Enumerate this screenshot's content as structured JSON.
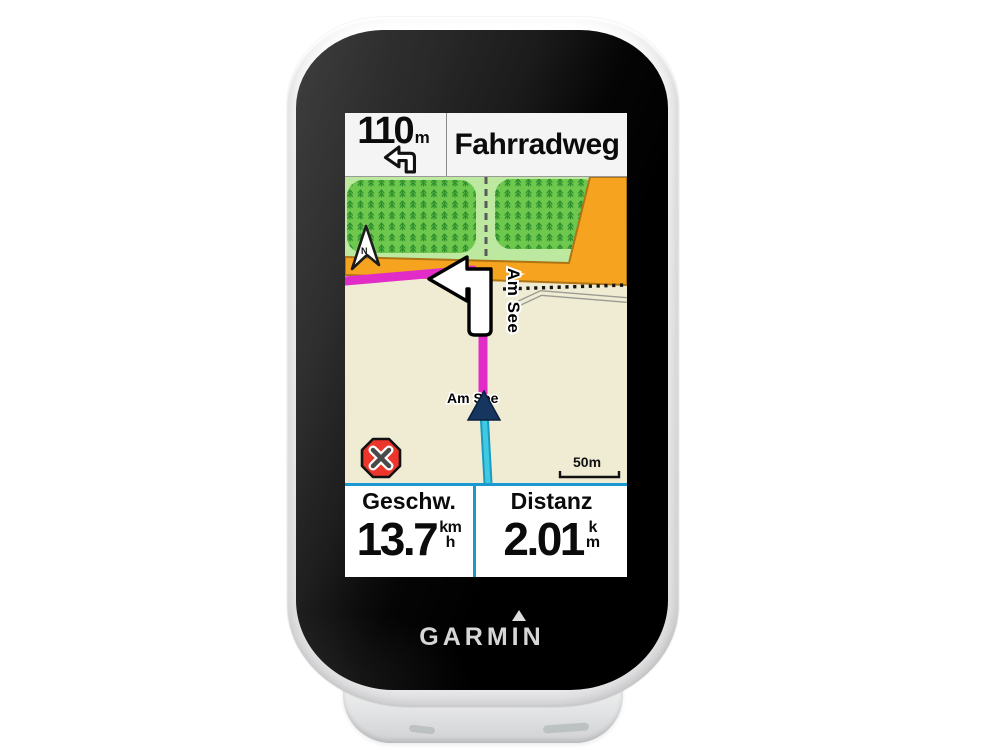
{
  "device": {
    "brand_logo": "GARMIN"
  },
  "navigation_banner": {
    "turn_distance_value": "110",
    "turn_distance_unit": "m",
    "turn_icon": "turn-left-icon",
    "street_name": "Fahrradweg"
  },
  "map": {
    "compass_label": "N",
    "street_label_vertical": "Am See",
    "street_label_position": "Am See",
    "scale_bar_label": "50m",
    "stop_button_icon": "stop-navigation-icon",
    "colors": {
      "land": "#F0ECD3",
      "meadow": "#BCE8A0",
      "forest": "#6FC84E",
      "tree_glyph": "#2E8F2E",
      "road": "#F6A41F",
      "road_border": "#AF7414",
      "route": "#E12CC7",
      "track": "#3FC9E2",
      "position_arrow": "#16355F",
      "stop_red": "#EC352B"
    }
  },
  "data_fields": {
    "divider_color": "#1B98D1",
    "speed": {
      "label": "Geschw.",
      "value": "13.7",
      "unit_top": "km",
      "unit_bottom": "h"
    },
    "distance": {
      "label": "Distanz",
      "value": "2.01",
      "unit_top": "k",
      "unit_bottom": "m"
    }
  }
}
